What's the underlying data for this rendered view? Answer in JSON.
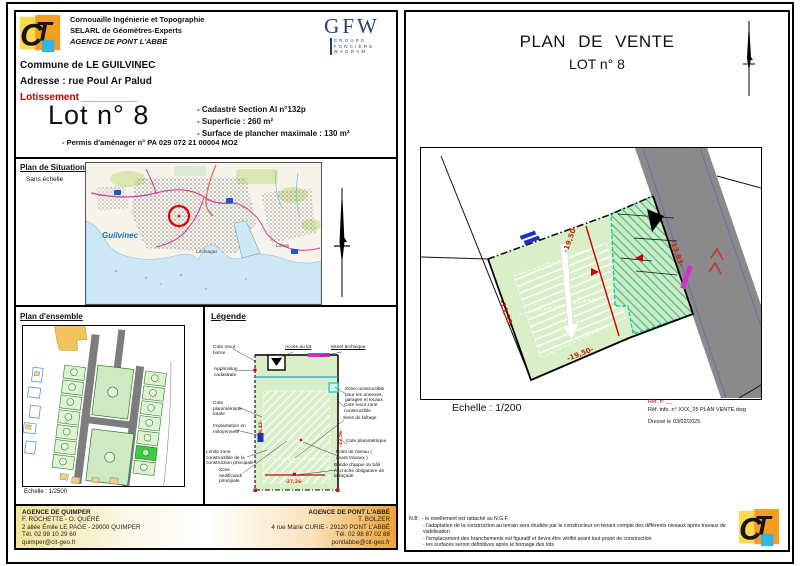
{
  "header": {
    "company_lines": [
      "Cornouaille Ingénierie et Topographie",
      "SELARL de Géomètres-Experts",
      "AGENCE DE PONT L'ABBÉ"
    ],
    "gfw_acronym": "GFW",
    "gfw_lines": [
      "GROUPE",
      "FONCIÈRE",
      "WAGRAM"
    ]
  },
  "project": {
    "commune": "Commune de LE GUILVINEC",
    "adresse": "Adresse  : rue Poul Ar Palud",
    "lotissement": "Lotissement __________",
    "lot_title": "Lot n° 8",
    "details": [
      "- Cadastré Section    AI n°132p",
      "- Superficie :    260 m²",
      "- Surface de plancher maximale :   130 m²"
    ],
    "permis": "- Permis d'aménager n° PA 029 072 21 00004 MO2"
  },
  "situation": {
    "title": "Plan de Situation",
    "subtitle": "Sans échelle",
    "map_labels": {
      "town": "Guilvinec",
      "district1": "Léchiagat",
      "district2": "Lohan"
    }
  },
  "ensemble": {
    "title": "Plan d'ensemble",
    "scale": "Echelle : 1/2500"
  },
  "legende": {
    "title": "Légende",
    "left_labels": [
      "Cote recul borne",
      "Application cadastrale",
      "Cote planimétrique totale",
      "Implantation en mitoyenneté",
      "Limite zone constructible de la construction principale",
      "Zone aedificandi principale"
    ],
    "top_labels": [
      "Accès au lot",
      "Muret technique"
    ],
    "right_labels": [
      "Zone constructible pour les annexes, garages et locaux",
      "Cote recul zone constructible",
      "Sens de faîtage",
      "Cote planimétrique",
      "Point de niveau ( avant travaux )",
      "Bande d'appui du bâti Accroche obligatoire de la façade"
    ],
    "dims": {
      "bottom": "-27,26-",
      "left": "-9,42-",
      "right": "-23,56-"
    }
  },
  "footer": {
    "quimper": {
      "title": "AGENCE DE QUIMPER",
      "lines": [
        "F. ROCHETTE - O. QUÉRÉ",
        "2 allée Émile LE PAGE - 29000 QUIMPER",
        "Tél. 02 98 10 29 60",
        "quimper@cit-geo.fr"
      ]
    },
    "pont_labbe": {
      "title": "AGENCE DE PONT L'ABBÉ",
      "lines": [
        "T. BOLZER",
        "4 rue Marie CURIE - 29120 PONT L'ABBÉ",
        "Tél. 02 98 87 02 88",
        "pontlabbe@cit-geo.fr"
      ]
    }
  },
  "vente": {
    "title_line1": "PLAN DE VENTE",
    "title_line2": "LOT n° 8",
    "scale": "Echelle : 1/200",
    "ref_red": "Réf. n° __",
    "ref_info": "Réf. info. n° XXX_25 PLAN VENTE.dwg",
    "date": "Dressé le 03/02/2025",
    "dims": {
      "top": "-19,50-",
      "bottom": "-19,50-",
      "left": "-13,33-",
      "right": "-13,83-"
    },
    "nb_lines": [
      "N.B : - le nivellement est rattaché au N.G.F.",
      "- l'adaptation de la construction au terrain sera étudiée par le constructeur en tenant compte des différents niveaux après travaux de viabilisation",
      "- l'emplacement des branchements est figuratif et devra être vérifié avant tout projet de construction",
      "- les surfaces seront définitives après le bornage des lots"
    ]
  },
  "colors": {
    "accent_red": "#c00000",
    "parcel_green": "#d9efc8",
    "teal_dash": "#17c3b2",
    "road_gray": "#8a8a8a",
    "muret_magenta": "#c837c8",
    "gfw_navy": "#27406e"
  }
}
